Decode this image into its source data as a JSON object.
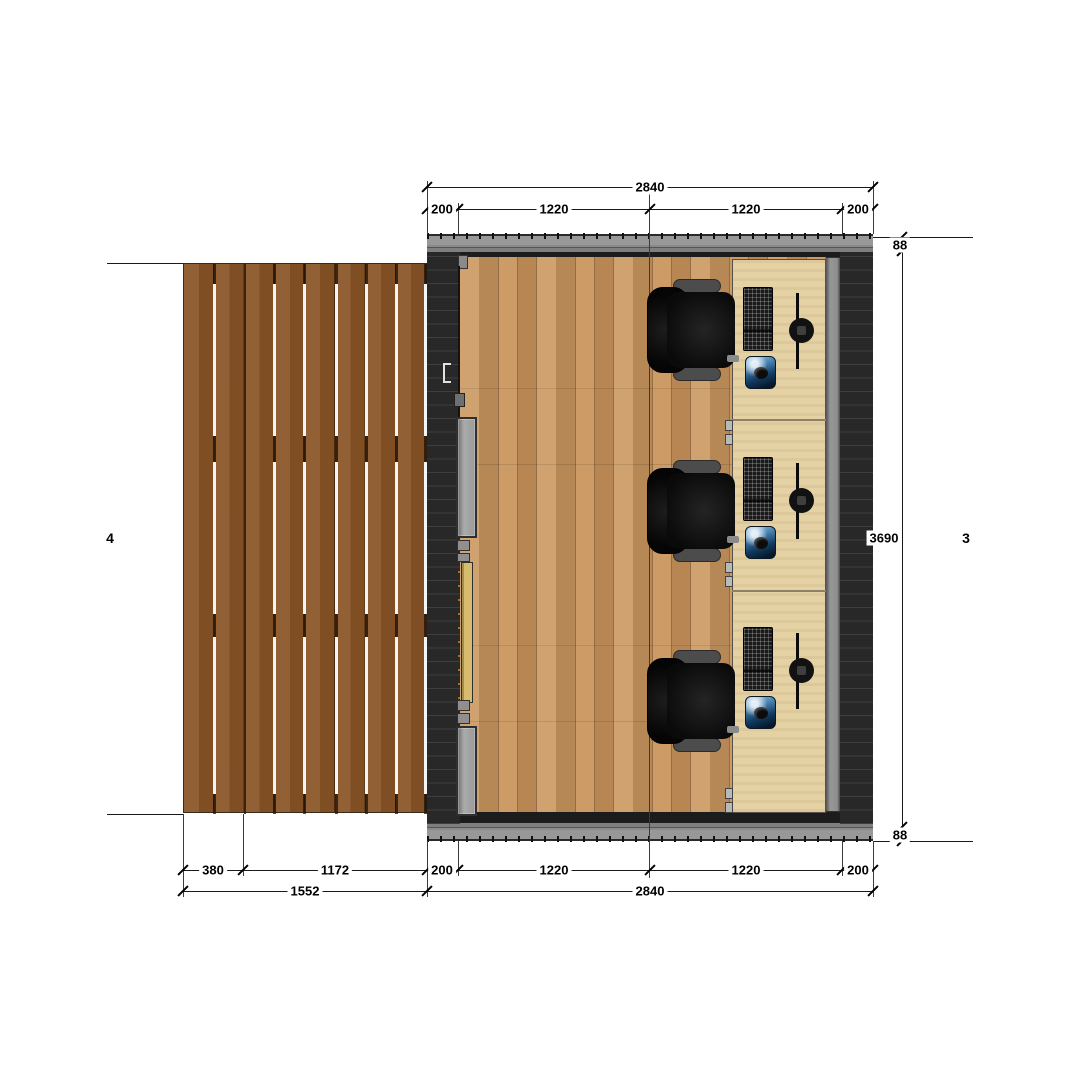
{
  "grid": {
    "left": "4",
    "right": "3"
  },
  "dims": {
    "top": {
      "overall": "2840",
      "segments": [
        "200",
        "1220",
        "1220",
        "200"
      ]
    },
    "right": {
      "top": "88",
      "middle": "3690",
      "bottom": "88"
    },
    "bottom": {
      "row1": [
        "380",
        "1172",
        "200",
        "1220",
        "1220",
        "200"
      ],
      "row2": [
        "1552",
        "2840"
      ]
    }
  },
  "objects": {
    "deck": "timber-deck",
    "floor": "wood-plank-floor",
    "desk": "worktop-desk",
    "door": "sliding-glass-door",
    "workstation_items": [
      "office-chair",
      "keyboard",
      "monitor",
      "mouse-pad"
    ],
    "workstation_count": 3
  },
  "colors": {
    "deck": "#8a5426",
    "floor": "#cb9760",
    "desk": "#e4d1a4",
    "wall": "#282828",
    "wall_band": "#989898",
    "door_glass": "#d7bc6d",
    "chair": "#111111",
    "mousepad": "#123c63",
    "dimension_text": "#000000"
  }
}
